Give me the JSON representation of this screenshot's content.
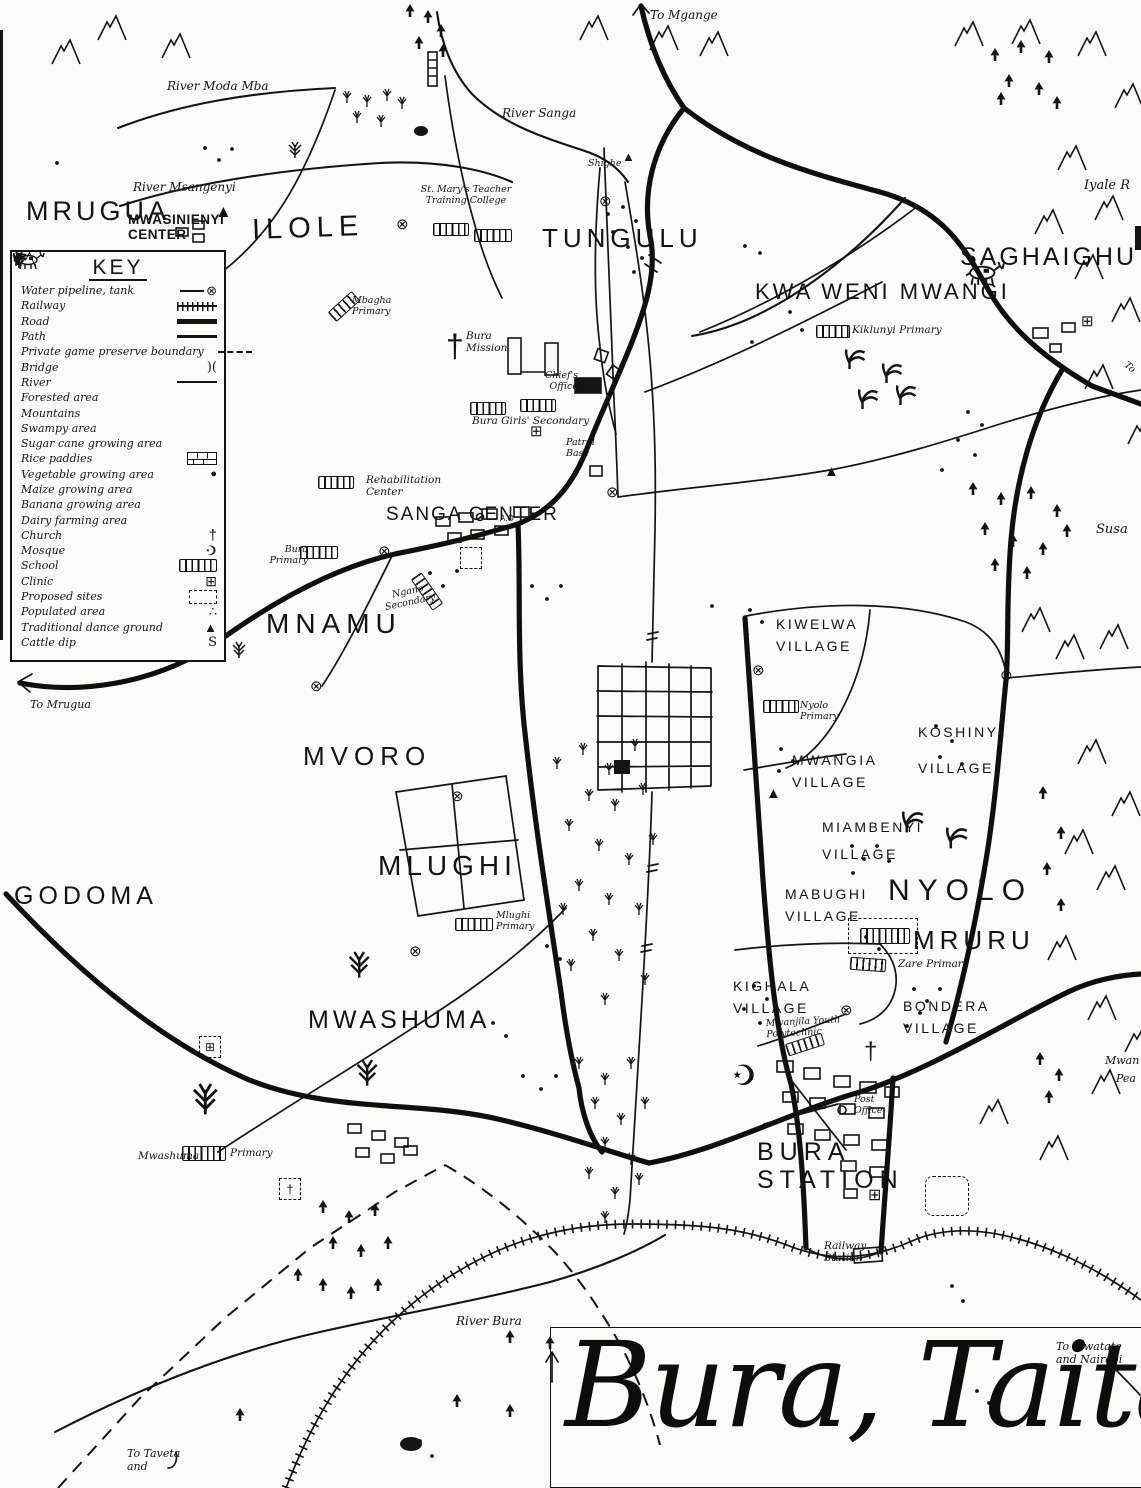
{
  "title_box": {
    "title": "Bura, Taita"
  },
  "key": {
    "title": "KEY",
    "items": [
      {
        "label": "Water pipeline, tank"
      },
      {
        "label": "Railway"
      },
      {
        "label": "Road"
      },
      {
        "label": "Path"
      },
      {
        "label": "Private game preserve boundary"
      },
      {
        "label": "Bridge"
      },
      {
        "label": "River"
      },
      {
        "label": "Forested area"
      },
      {
        "label": "Mountains"
      },
      {
        "label": "Swampy area"
      },
      {
        "label": "Sugar cane growing area"
      },
      {
        "label": "Rice paddies"
      },
      {
        "label": "Vegetable growing area"
      },
      {
        "label": "Maize growing area"
      },
      {
        "label": "Banana growing area"
      },
      {
        "label": "Dairy farming area"
      },
      {
        "label": "Church"
      },
      {
        "label": "Mosque"
      },
      {
        "label": "School"
      },
      {
        "label": "Clinic"
      },
      {
        "label": "Proposed sites"
      },
      {
        "label": "Populated area"
      },
      {
        "label": "Traditional dance ground"
      },
      {
        "label": "Cattle dip"
      }
    ]
  },
  "regions": {
    "mrugua": "MRUGUA",
    "ilole": "ILOLE",
    "tungulu": "TUNGULU",
    "kwa_weni_mwangi": "KWA WENI MWANGI",
    "saghaighu": "SAGHAIGHU",
    "mnamu": "MNAMU",
    "mvoro": "MVORO",
    "godoma": "GODOMA",
    "mlughi": "MLUGHI",
    "mwashuma": "MWASHUMA",
    "nyolo": "NYOLO",
    "mruru": "MRURU",
    "bura_station": "BURA STATION",
    "sanga_center": "SANGA CENTER",
    "mwasinienyi_center": "MWASINIENYI CENTER"
  },
  "villages": {
    "kiwelwa": "KIWELWA VILLAGE",
    "mwangia": "MWANGIA VILLAGE",
    "koshinyi": "KOSHINYI VILLAGE",
    "miambenyi": "MIAMBENYI VILLAGE",
    "mabughi": "MABUGHI VILLAGE",
    "kighala": "KIGHALA VILLAGE",
    "bondera": "BONDERA VILLAGE"
  },
  "places": {
    "st_marys": "St. Mary's Teacher Training College",
    "mbagha_primary": "Mbagha Primary",
    "bura_mission": "Bura Mission",
    "chiefs_office": "Chief's Office",
    "bura_girls_secondary": "Bura Girls' Secondary",
    "patrol_base": "Patrol Base",
    "rehabilitation_center": "Rehabilitation Center",
    "bura_primary": "Bura Primary",
    "ngano_secondary": "Ngano Secondary",
    "kiklunyi_primary": "Kiklunyi Primary",
    "nyolo_primary": "Nyolo Primary",
    "mlughi_primary": "Mlughi Primary",
    "zare_primary": "Zare Primary",
    "mwanjila_polytechnic": "Mwanjila Youth Polytechnic",
    "mwashuma_label": "Mwashuma",
    "mwashuma_primary_suffix": "Primary",
    "post_office": "Post Office",
    "railway_station": "Railway Station",
    "admin_office": "A.O"
  },
  "rivers": {
    "moda_mba": "River Moda Mba",
    "sanga": "River Sanga",
    "msangenyi": "River Msangenyi",
    "bura": "River Bura"
  },
  "directions": {
    "to_mgange": "To Mgange",
    "to_mrugua": "To Mrugua",
    "to_taveta": "To Taveta and",
    "to_mwatate": "To Mwatate and Nairobi",
    "to_edge": "To"
  },
  "peak_labels": {
    "shighe": "Shighe",
    "iyale": "Iyale R",
    "susa": "Susa",
    "mwan": "Mwan",
    "pea": "Pea"
  },
  "icons": {
    "water_tank": "⊗",
    "church": "†",
    "mosque": "☪",
    "clinic": "⊞",
    "dance_ground": "▲",
    "cattle_dip": "S",
    "bridge": ")(",
    "vegetable": "●",
    "populated": "∴"
  },
  "colors": {
    "ink": "#141414",
    "paper": "#fbfbf8"
  }
}
